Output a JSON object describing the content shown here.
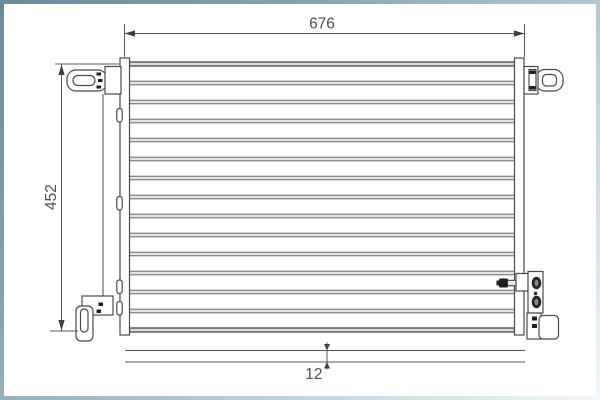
{
  "diagram": {
    "type": "technical-drawing",
    "subject": "condenser with mounting brackets, front view and depth profile",
    "dimensions": {
      "width": "676",
      "height": "452",
      "depth": "12"
    },
    "core": {
      "tube_count": 13
    },
    "colors": {
      "line": "#4a4a4a",
      "dim_line": "#5a5a5a",
      "text": "#4f4f4f",
      "tube_fill": "#e4e4e4",
      "tube_edge": "#6a6a6a",
      "core_edge_fill": "#dcdcdc",
      "core_edge_stroke": "#3b3b3b",
      "dark_fill": "#1f1f1f",
      "frame_gradient_start": "#6b8b98",
      "frame_gradient_end": "#f2f7f8"
    }
  }
}
